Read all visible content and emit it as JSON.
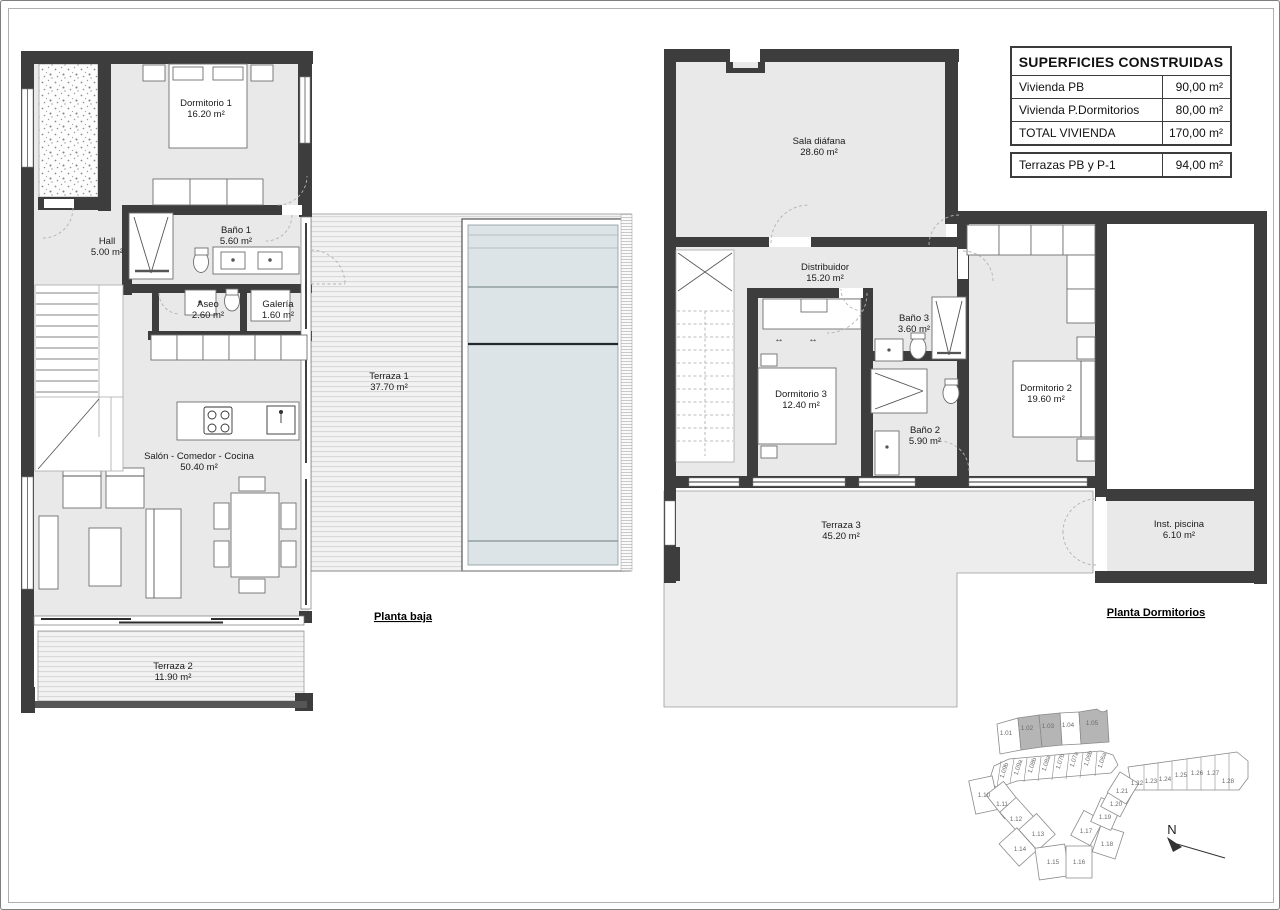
{
  "table": {
    "title": "SUPERFICIES CONSTRUIDAS",
    "rows": [
      {
        "label": "Vivienda PB",
        "value": "90,00 m²"
      },
      {
        "label": "Vivienda P.Dormitorios",
        "value": "80,00 m²"
      },
      {
        "label": "TOTAL VIVIENDA",
        "value": "170,00 m²"
      }
    ],
    "footer_row": {
      "label": "Terrazas PB y P-1",
      "value": "94,00 m²"
    }
  },
  "plans": {
    "ground_floor": {
      "caption": "Planta baja",
      "rooms": [
        {
          "name": "Dormitorio 1",
          "area": "16.20 m²"
        },
        {
          "name": "Hall",
          "area": "5.00 m²"
        },
        {
          "name": "Baño 1",
          "area": "5.60 m²"
        },
        {
          "name": "Aseo",
          "area": "2.60 m²"
        },
        {
          "name": "Galería",
          "area": "1.60 m²"
        },
        {
          "name": "Terraza 1",
          "area": "37.70 m²"
        },
        {
          "name": "Salón - Comedor - Cocina",
          "area": "50.40 m²"
        },
        {
          "name": "Terraza 2",
          "area": "11.90 m²"
        }
      ]
    },
    "bedroom_floor": {
      "caption": "Planta Dormitorios",
      "rooms": [
        {
          "name": "Sala diáfana",
          "area": "28.60 m²"
        },
        {
          "name": "Distribuidor",
          "area": "15.20 m²"
        },
        {
          "name": "Baño 3",
          "area": "3.60 m²"
        },
        {
          "name": "Dormitorio 3",
          "area": "12.40 m²"
        },
        {
          "name": "Baño 2",
          "area": "5.90 m²"
        },
        {
          "name": "Dormitorio 2",
          "area": "19.60 m²"
        },
        {
          "name": "Inst. piscina",
          "area": "6.10 m²"
        },
        {
          "name": "Terraza 3",
          "area": "45.20 m²"
        }
      ]
    }
  },
  "icons": {
    "wardrobe_arrow": "↔"
  },
  "site_plan": {
    "north_label": "N",
    "plots": [
      {
        "label": "1.01"
      },
      {
        "label": "1.02"
      },
      {
        "label": "1.03"
      },
      {
        "label": "1.04"
      },
      {
        "label": "1.05"
      },
      {
        "label": "1.09b"
      },
      {
        "label": "1.09a"
      },
      {
        "label": "1.08b"
      },
      {
        "label": "1.08a"
      },
      {
        "label": "1.07b"
      },
      {
        "label": "1.07a"
      },
      {
        "label": "1.06b"
      },
      {
        "label": "1.06a"
      },
      {
        "label": "1.10"
      },
      {
        "label": "1.11"
      },
      {
        "label": "1.12"
      },
      {
        "label": "1.13"
      },
      {
        "label": "1.14"
      },
      {
        "label": "1.15"
      },
      {
        "label": "1.16"
      },
      {
        "label": "1.17"
      },
      {
        "label": "1.18"
      },
      {
        "label": "1.19"
      },
      {
        "label": "1.20"
      },
      {
        "label": "1.21"
      },
      {
        "label": "1.22"
      },
      {
        "label": "1.23"
      },
      {
        "label": "1.24"
      },
      {
        "label": "1.25"
      },
      {
        "label": "1.26"
      },
      {
        "label": "1.27"
      },
      {
        "label": "1.28"
      }
    ]
  },
  "colors": {
    "wall": "#3d3d3d",
    "room_fill": "#e9e9e9",
    "terrace_fill": "#f2f2f2",
    "pool_fill": "#dce4e7",
    "highlighted_plot": "#b5b5b5"
  }
}
